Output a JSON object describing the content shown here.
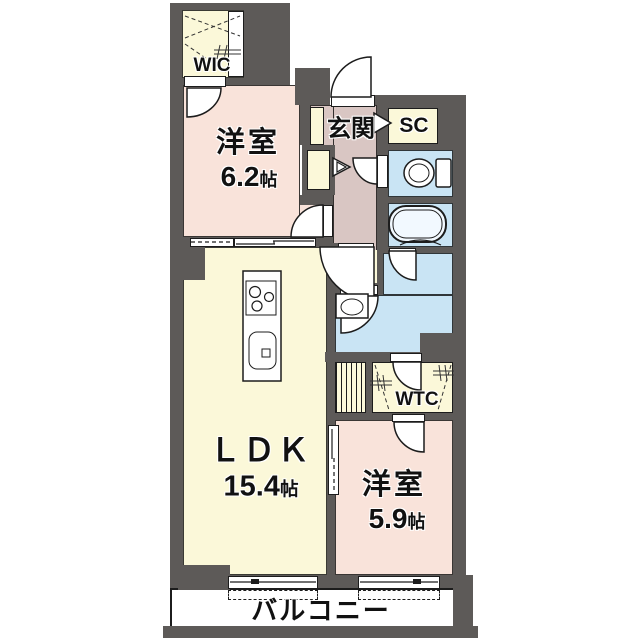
{
  "plan": {
    "wic_label": "WIC",
    "bedroom1_name": "洋室",
    "bedroom1_size": "6.2",
    "bedroom1_unit": "帖",
    "entrance_label": "玄関",
    "sc_label": "SC",
    "ldk_name": "ＬＤＫ",
    "ldk_size": "15.4",
    "ldk_unit": "帖",
    "wtc_label": "WTC",
    "bedroom2_name": "洋室",
    "bedroom2_size": "5.9",
    "bedroom2_unit": "帖",
    "balcony_label": "バルコニー"
  },
  "colors": {
    "wall": "#5d5a58",
    "line": "#1c1c1c",
    "pink": "#f9e3da",
    "cream": "#fbf8d9",
    "blue": "#c9e4f4",
    "mauve": "#d9c6c3"
  }
}
